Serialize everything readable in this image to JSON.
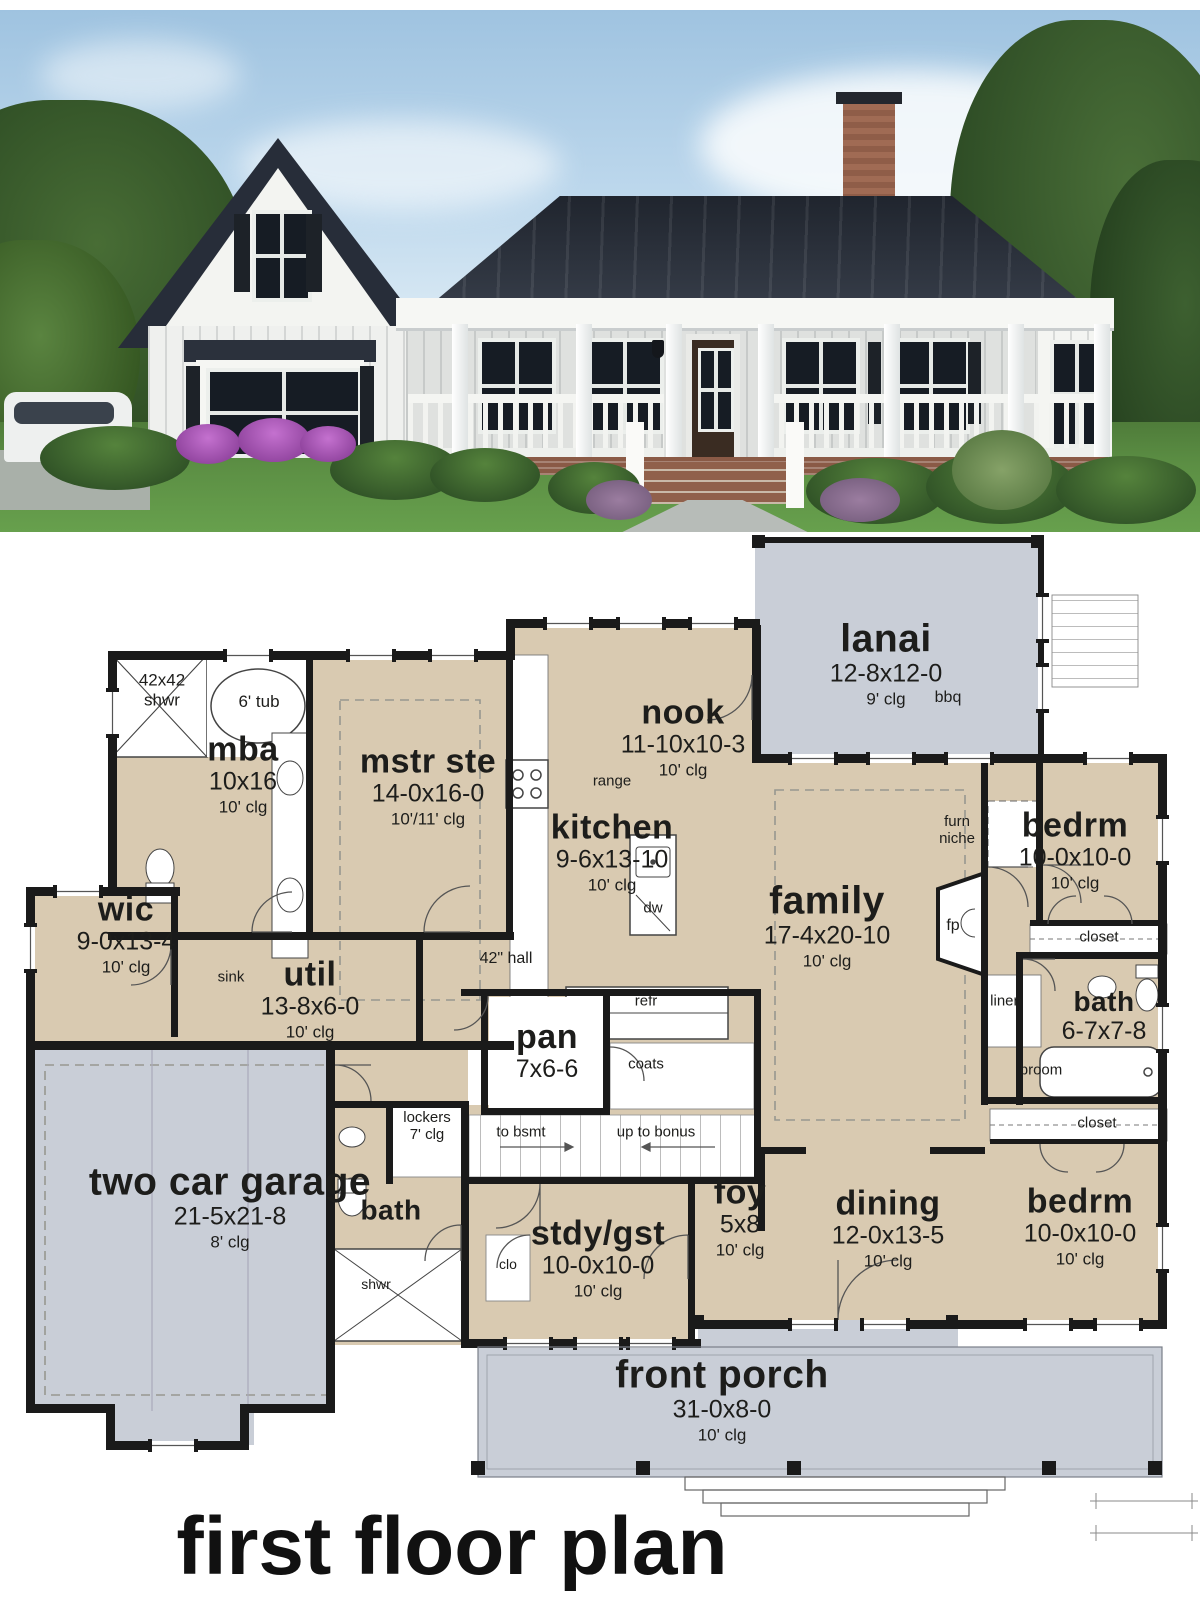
{
  "colors": {
    "room_fill": "#d9cab1",
    "outdoor_fill": "#c9ced7",
    "wall": "#1a1a1a",
    "sky": "#b6d0e6",
    "roof": "#2b313c",
    "grass": "#4e7a38",
    "brick": "#96604a"
  },
  "plan": {
    "title": "first floor plan",
    "rooms": [
      {
        "name": "mba",
        "dims": "10x16",
        "clg": "10' clg"
      },
      {
        "name": "mstr ste",
        "dims": "14-0x16-0",
        "clg": "10'/11' clg"
      },
      {
        "name": "wic",
        "dims": "9-0x13-4",
        "clg": "10' clg"
      },
      {
        "name": "util",
        "dims": "13-8x6-0",
        "clg": "10' clg"
      },
      {
        "name": "kitchen",
        "dims": "9-6x13-10",
        "clg": "10' clg"
      },
      {
        "name": "nook",
        "dims": "11-10x10-3",
        "clg": "10' clg"
      },
      {
        "name": "lanai",
        "dims": "12-8x12-0",
        "clg": "9' clg"
      },
      {
        "name": "family",
        "dims": "17-4x20-10",
        "clg": "10' clg"
      },
      {
        "name": "bedrm",
        "dims": "10-0x10-0",
        "clg": "10' clg"
      },
      {
        "name": "bath",
        "dims": "6-7x7-8",
        "clg": ""
      },
      {
        "name": "pan",
        "dims": "7x6-6",
        "clg": ""
      },
      {
        "name": "two car garage",
        "dims": "21-5x21-8",
        "clg": "8' clg"
      },
      {
        "name": "bath",
        "dims": "",
        "clg": ""
      },
      {
        "name": "stdy/gst",
        "dims": "10-0x10-0",
        "clg": "10' clg"
      },
      {
        "name": "foy",
        "dims": "5x8",
        "clg": "10' clg"
      },
      {
        "name": "dining",
        "dims": "12-0x13-5",
        "clg": "10' clg"
      },
      {
        "name": "bedrm",
        "dims": "10-0x10-0",
        "clg": "10' clg"
      },
      {
        "name": "front porch",
        "dims": "31-0x8-0",
        "clg": "10' clg"
      }
    ],
    "labels": {
      "shwr_size": "42x42",
      "shwr": "shwr",
      "tub": "6' tub",
      "sink": "sink",
      "range": "range",
      "dw": "dw",
      "refr": "refr",
      "coats": "coats",
      "hall": "42\" hall",
      "lockers": "lockers",
      "lockers_clg": "7' clg",
      "to_bsmt": "to bsmt",
      "up_to_bonus": "up to bonus",
      "furn": "furn",
      "niche": "niche",
      "fp": "fp",
      "linen": "linen",
      "broom": "broom",
      "closet_1": "closet",
      "closet_2": "closet",
      "clo": "clo",
      "shwr_2": "shwr",
      "bbq": "bbq"
    }
  }
}
